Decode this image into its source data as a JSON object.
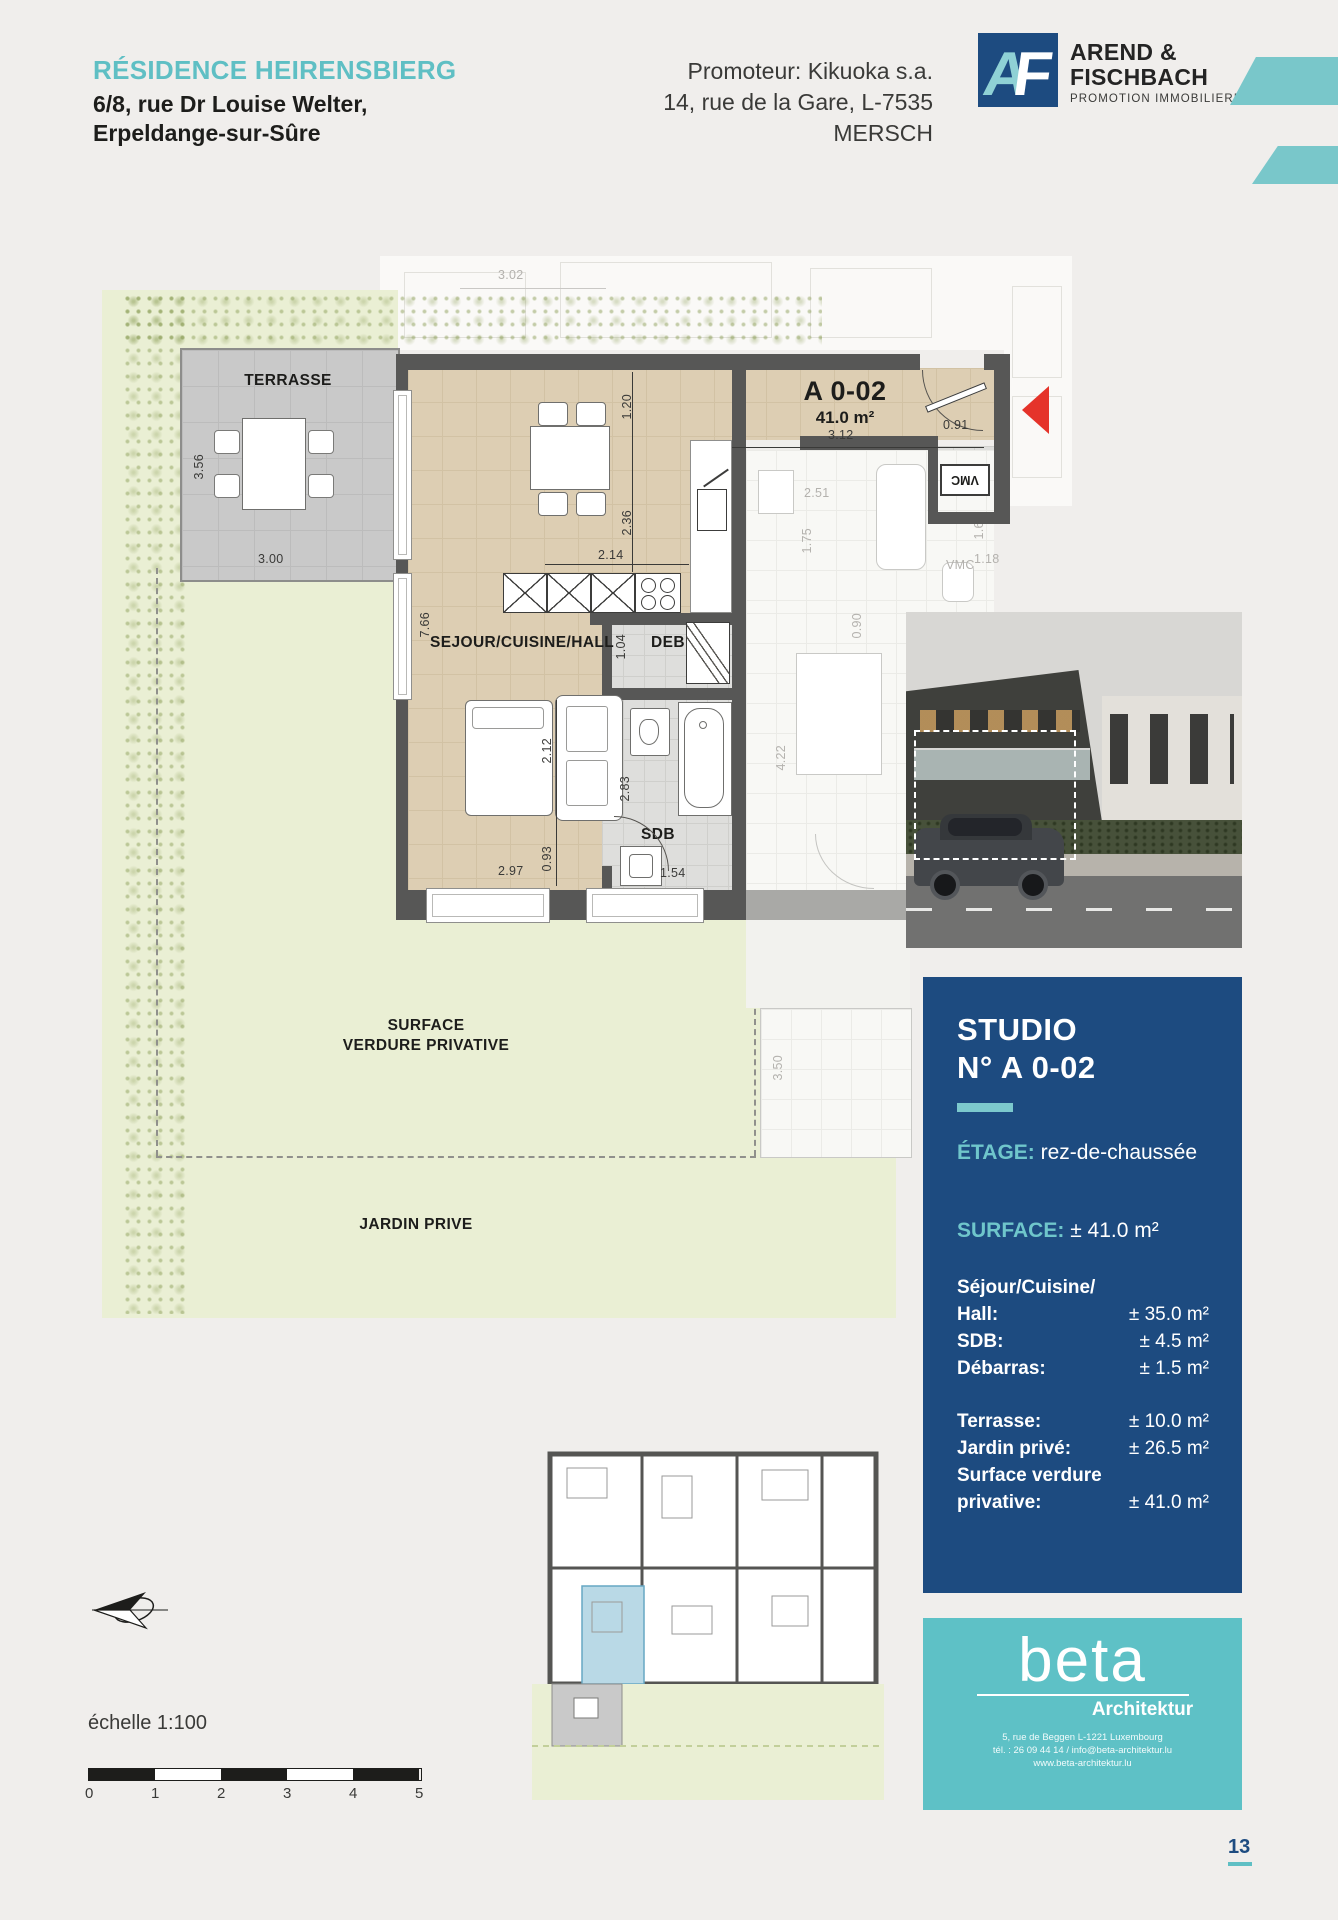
{
  "header": {
    "residence_title": "RÉSIDENCE HEIRENSBIERG",
    "residence_address_line1": "6/8, rue Dr Louise Welter,",
    "residence_address_line2": "Erpeldange-sur-Sûre",
    "promoter_line1": "Promoteur: Kikuoka s.a.",
    "promoter_line2": "14, rue de la Gare, L-7535 MERSCH",
    "brand": {
      "monogram_a": "A",
      "monogram_f": "F",
      "name_line1": "AREND &",
      "name_line2": "FISCHBACH",
      "tagline": "PROMOTION IMMOBILIERE"
    }
  },
  "floorplan": {
    "unit_code": "A 0-02",
    "unit_area": "41.0 m²",
    "labels": {
      "terrace": "TERRASSE",
      "living": "SEJOUR/CUISINE/HALL",
      "storage": "DEB",
      "bathroom": "SDB",
      "vmc_unit": "VMC",
      "vmc_neighbor": "VMC",
      "surface_verdure_line1": "SURFACE",
      "surface_verdure_line2": "VERDURE PRIVATIVE",
      "garden": "JARDIN PRIVE"
    },
    "dimensions": {
      "d302": "3.02",
      "d120": "1.20",
      "d312": "3.12",
      "d091": "0.91",
      "d251": "2.51",
      "d175": "1.75",
      "d162": "1.62",
      "d118": "1.18",
      "d236": "2.36",
      "d214": "2.14",
      "d766": "7.66",
      "d104": "1.04",
      "d090": "0.90",
      "d422": "4.22",
      "d212": "2.12",
      "d283": "2.83",
      "d093": "0.93",
      "d297": "2.97",
      "d154": "1.54",
      "d356": "3.56",
      "d300": "3.00",
      "d350": "3.50"
    }
  },
  "info_panel": {
    "title_line1": "STUDIO",
    "title_line2": "N° A 0-02",
    "etage_label": "ÉTAGE:",
    "etage_value": "rez-de-chaussée",
    "surface_label": "SURFACE:",
    "surface_value": "± 41.0 m²",
    "rows": [
      {
        "label": "Séjour/Cuisine/",
        "value": ""
      },
      {
        "label": "Hall:",
        "value": "± 35.0 m²"
      },
      {
        "label": "SDB:",
        "value": "± 4.5 m²"
      },
      {
        "label": "Débarras:",
        "value": "± 1.5 m²"
      },
      {
        "label": "Terrasse:",
        "value": "± 10.0 m²"
      },
      {
        "label": "Jardin privé:",
        "value": "± 26.5 m²"
      },
      {
        "label": "Surface verdure",
        "value": ""
      },
      {
        "label": "privative:",
        "value": "± 41.0 m²"
      }
    ]
  },
  "architect": {
    "logo_text": "beta",
    "logo_subtitle": "Architektur",
    "address_line1": "5, rue de Beggen L-1221 Luxembourg",
    "address_line2": "tél. : 26 09 44 14 / info@beta-architektur.lu",
    "address_line3": "www.beta-architektur.lu"
  },
  "footer": {
    "scale_label": "échelle 1:100",
    "scale_ticks": [
      "0",
      "1",
      "2",
      "3",
      "4",
      "5"
    ],
    "page_number": "13"
  },
  "colors": {
    "teal": "#5fbfc4",
    "dark_blue": "#1d4b80",
    "wall_grey": "#575756",
    "floor_beige": "#ddceb3",
    "garden_green": "#eaefd4",
    "red_arrow": "#e5332a"
  }
}
